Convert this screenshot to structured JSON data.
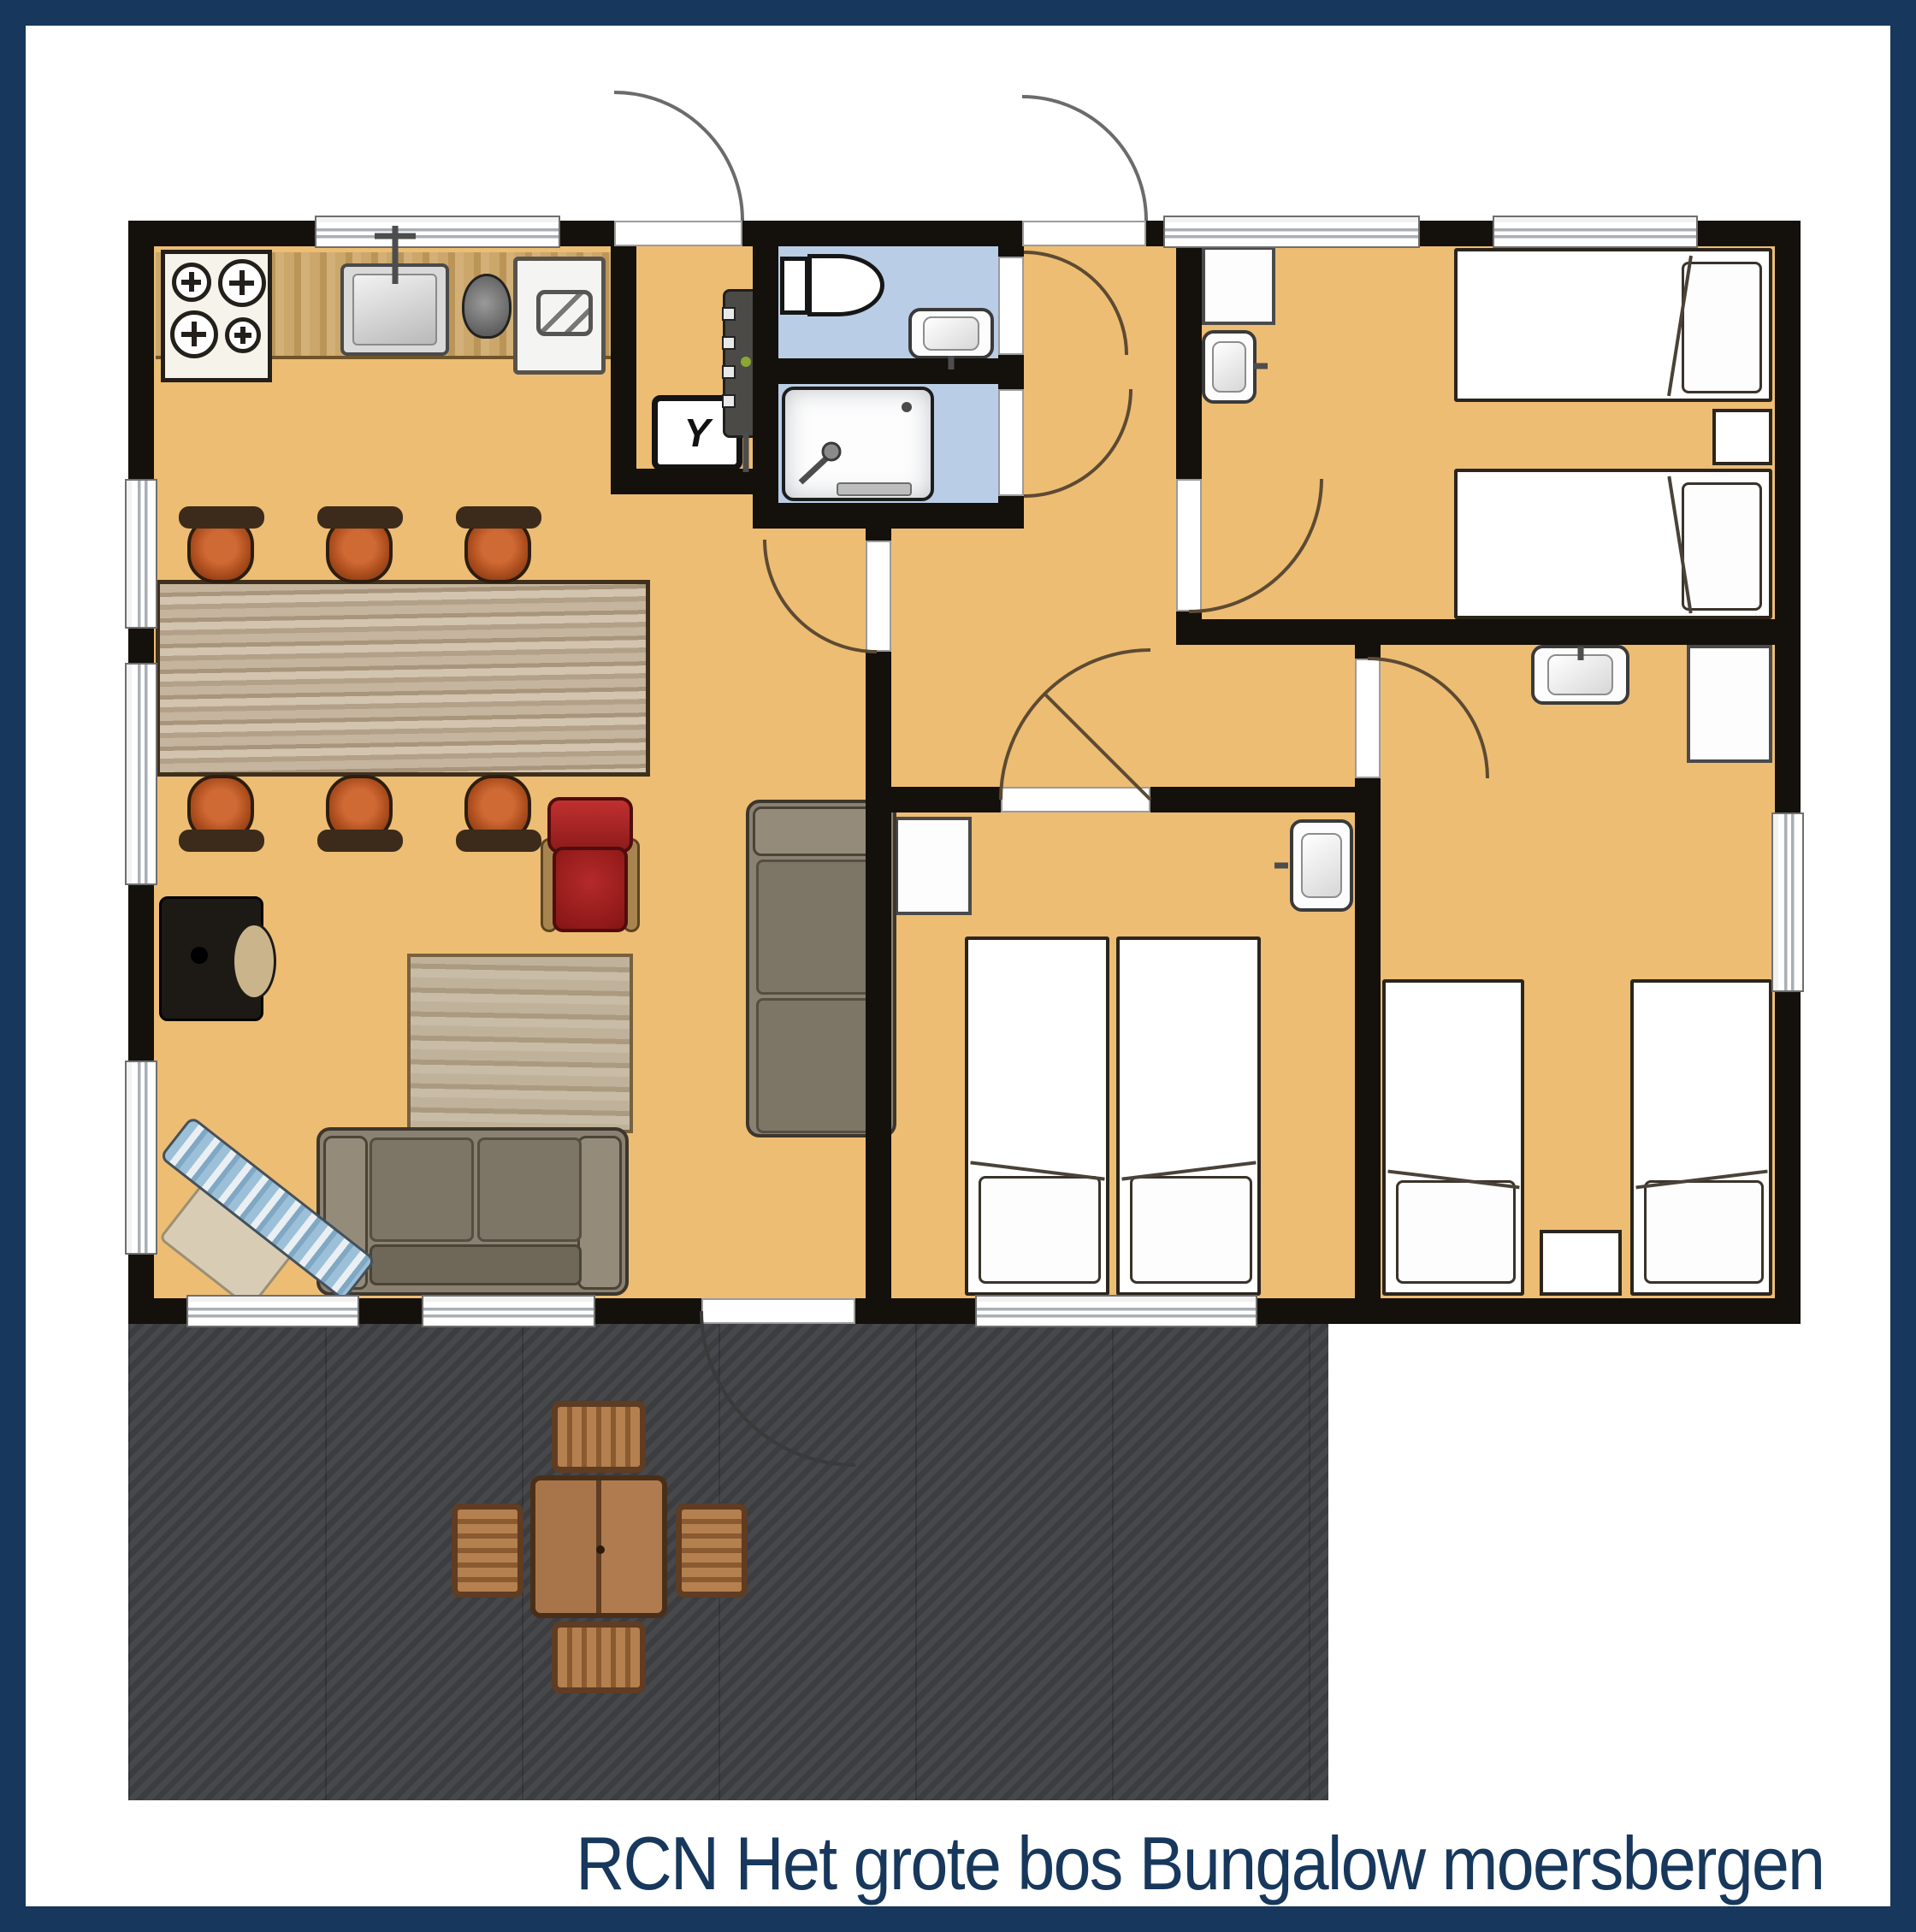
{
  "caption": {
    "text": "RCN Het grote bos Bungalow moersbergen"
  },
  "palette": {
    "frame_navy": "#17385c",
    "wall_black": "#14100b",
    "floor_orange": "#edbd74",
    "bathroom_blue": "#b9cee6",
    "terrace_gray": "#3f4144",
    "caption_navy": "#17385c"
  },
  "entry_hall": {
    "meter_symbol": "Y"
  },
  "floor_plan": {
    "rooms": [
      {
        "name": "kitchen-living-room",
        "floor": "orange"
      },
      {
        "name": "entry-hall",
        "floor": "orange"
      },
      {
        "name": "toilet-room",
        "floor": "blue"
      },
      {
        "name": "shower-room",
        "floor": "blue"
      },
      {
        "name": "hallway",
        "floor": "orange"
      },
      {
        "name": "bedroom-top-right",
        "floor": "orange"
      },
      {
        "name": "bedroom-middle",
        "floor": "orange"
      },
      {
        "name": "bedroom-bottom-right",
        "floor": "orange"
      },
      {
        "name": "terrace",
        "floor": "dark-gray"
      }
    ],
    "furniture": [
      "stove-4-burners",
      "kitchen-counter",
      "kitchen-sink",
      "kettle",
      "dishwasher",
      "meter-cupboard",
      "boiler",
      "toilet",
      "washbasin-toilet-room",
      "shower-tray",
      "dining-table",
      "six-dining-chairs",
      "red-armchair",
      "wood-stove",
      "coffee-table",
      "sofa",
      "chaise-sofa",
      "lounge-chair",
      "two-beds-top-right",
      "nightstands",
      "closets",
      "washbasins-bedrooms",
      "two-beds-middle",
      "two-beds-bottom-right",
      "outdoor-table",
      "four-outdoor-chairs"
    ]
  }
}
